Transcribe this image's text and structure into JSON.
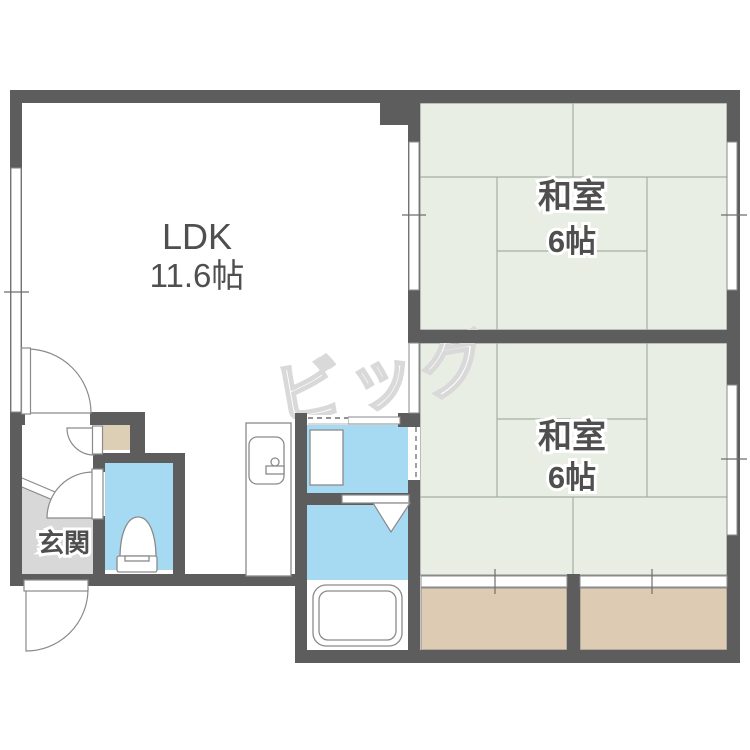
{
  "floorplan": {
    "rooms": {
      "ldk": {
        "label": "LDK",
        "area": "11.6帖"
      },
      "japanese_room_top": {
        "label": "和室",
        "area": "6帖"
      },
      "japanese_room_bottom": {
        "label": "和室",
        "area": "6帖"
      },
      "entrance": {
        "label": "玄関"
      }
    },
    "watermark": "ビッグ",
    "colors": {
      "wall": "#5d5d5d",
      "tatami_floor": "#e8eee4",
      "tatami_line": "#a3b0a0",
      "water_area": "#a6d9f2",
      "balcony": "#ddccb3",
      "closet": "#ddcfb6",
      "entrance_floor": "#d8d8d8",
      "outline": "#8a8a8a",
      "text": "#4f4f4f",
      "watermark": "#d9d9d9"
    }
  }
}
